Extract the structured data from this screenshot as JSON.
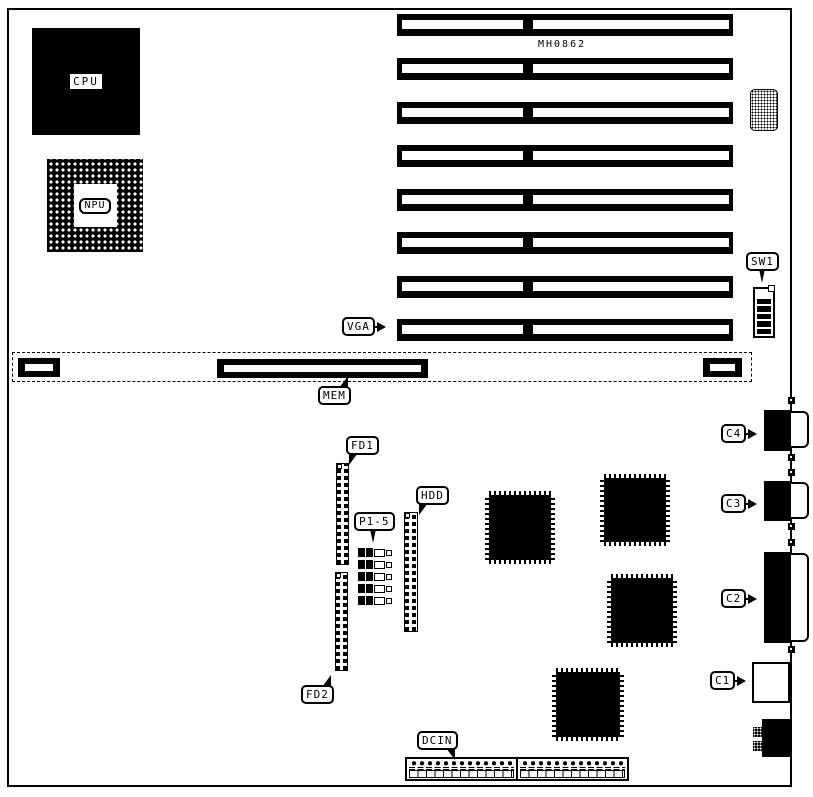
{
  "board": {
    "model": "MH0862",
    "components": {
      "cpu": {
        "label": "CPU"
      },
      "npu": {
        "label": "NPU"
      },
      "sw1": {
        "label": "SW1",
        "positions": 6
      },
      "vga": {
        "label": "VGA"
      },
      "memory": {
        "label": "MEM"
      },
      "floppy1": {
        "label": "FD1"
      },
      "floppy2": {
        "label": "FD2"
      },
      "jumpers": {
        "label": "P1-5",
        "count": 5
      },
      "hdd": {
        "label": "HDD"
      },
      "dc_in": {
        "label": "DCIN"
      },
      "c1": {
        "label": "C1"
      },
      "c2": {
        "label": "C2"
      },
      "c3": {
        "label": "C3"
      },
      "c4": {
        "label": "C4"
      }
    },
    "expansion_slots": {
      "count": 8
    },
    "qfp_chips": {
      "count": 4
    },
    "colors": {
      "ink": "#000000",
      "background": "#ffffff"
    }
  }
}
